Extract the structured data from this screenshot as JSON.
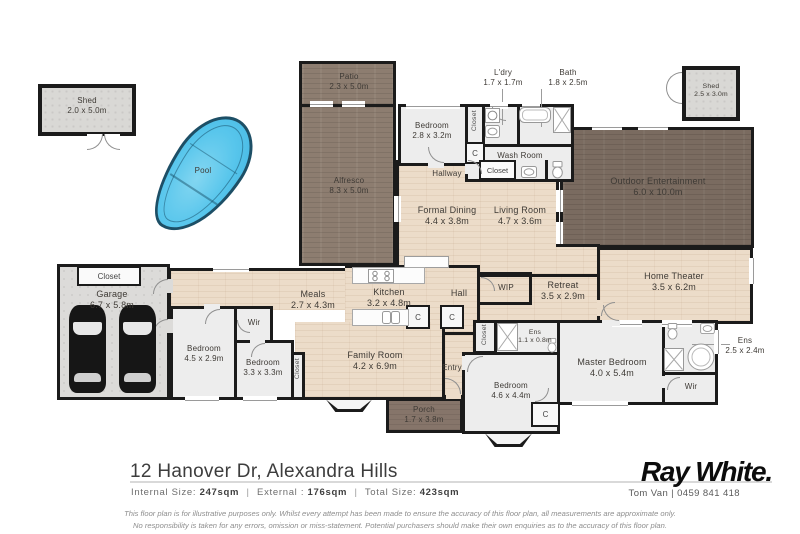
{
  "meta": {
    "title": "12 Hanover Dr, Alexandra Hills floor plan"
  },
  "colors": {
    "wall": "#1b1b1b",
    "wood_floor": "#ecdcc9",
    "outdoor_light": "#8d7d70",
    "outdoor_dark": "#7a6b60",
    "gray_room": "#ededed",
    "pool_water": "#58c6ec",
    "pool_edge": "#1d4f66"
  },
  "rooms": {
    "shed_left": {
      "name": "Shed",
      "dims": "2.0 x 5.0m"
    },
    "shed_right": {
      "name": "Shed",
      "dims": "2.5 x 3.0m"
    },
    "patio": {
      "name": "Patio",
      "dims": "2.3 x 5.0m"
    },
    "alfresco": {
      "name": "Alfresco",
      "dims": "8.3 x 5.0m"
    },
    "outdoor": {
      "name": "Outdoor Entertainment",
      "dims": "6.0 x 10.0m"
    },
    "porch": {
      "name": "Porch",
      "dims": "1.7 x 3.8m"
    },
    "bedroom_top": {
      "name": "Bedroom",
      "dims": "2.8 x 3.2m"
    },
    "ldry": {
      "name": "L'dry",
      "dims": "1.7 x 1.7m"
    },
    "bath": {
      "name": "Bath",
      "dims": "1.8 x 2.5m"
    },
    "formal_dining": {
      "name": "Formal Dining",
      "dims": "4.4 x 3.8m"
    },
    "living": {
      "name": "Living Room",
      "dims": "4.7 x 3.6m"
    },
    "meals": {
      "name": "Meals",
      "dims": "2.7 x 4.3m"
    },
    "kitchen": {
      "name": "Kitchen",
      "dims": "3.2 x 4.8m"
    },
    "retreat": {
      "name": "Retreat",
      "dims": "3.5 x 2.9m"
    },
    "home_theater": {
      "name": "Home Theater",
      "dims": "3.5 x 6.2m"
    },
    "garage": {
      "name": "Garage",
      "dims": "6.7 x 5.8m"
    },
    "bedroom_45": {
      "name": "Bedroom",
      "dims": "4.5 x 2.9m"
    },
    "bedroom_33": {
      "name": "Bedroom",
      "dims": "3.3 x 3.3m"
    },
    "family": {
      "name": "Family Room",
      "dims": "4.2 x 6.9m"
    },
    "master": {
      "name": "Master Bedroom",
      "dims": "4.0 x 5.4m"
    },
    "bedroom_46": {
      "name": "Bedroom",
      "dims": "4.6 x 4.4m"
    },
    "ens_small": {
      "name": "Ens",
      "dims": "1.1 x 0.8m"
    },
    "ens_big": {
      "name": "Ens",
      "dims": "2.5 x 2.4m"
    }
  },
  "labels": {
    "pool": "Pool",
    "closet": "Closet",
    "c": "C",
    "wir": "Wir",
    "hall": "Hall",
    "wip": "WIP",
    "entry": "Entry",
    "hallway": "Hallway",
    "washroom": "Wash Room"
  },
  "footer": {
    "address": "12 Hanover Dr, Alexandra Hills",
    "size_parts": [
      "Internal Size:",
      "247sqm",
      "|",
      "External :",
      "176sqm",
      "|",
      "Total Size:",
      "423sqm"
    ]
  },
  "branding": {
    "logo": "Ray White.",
    "agent": "Tom Van | 0459 841 418"
  },
  "disclaimer": {
    "line1": "This floor plan is for illustrative purposes only. Whilst every attempt has been made to ensure the accuracy of this floor plan, all measurements are approximate only.",
    "line2": "No responsibility is taken for any errors, omission or miss-statement. Potential purchasers should make their own enquiries as to the accuracy of this floor plan."
  }
}
